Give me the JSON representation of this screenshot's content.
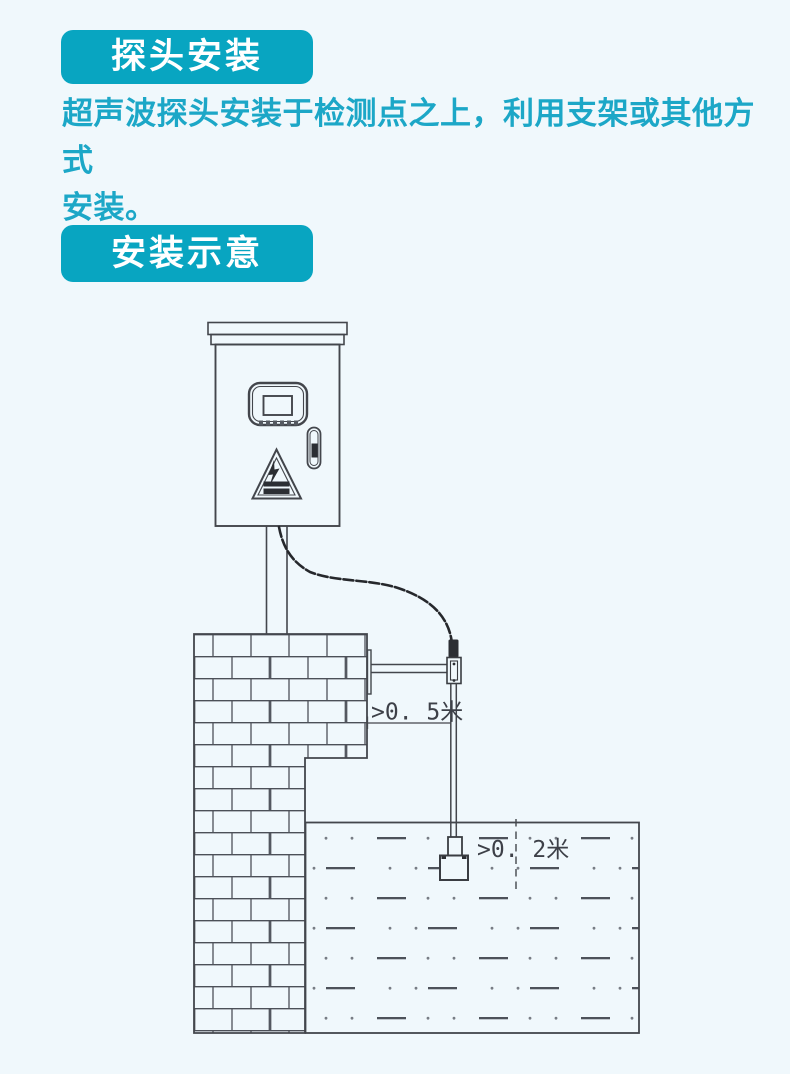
{
  "page": {
    "background_color": "#f0f8fc",
    "accent_color": "#08a5c1",
    "text_color": "#1ca7c7",
    "line_color": "#43464c"
  },
  "sections": {
    "probe_install": {
      "badge": "探头安装",
      "body": "超声波探头安装于检测点之上，利用支架或其他方式安装。",
      "body_lines": [
        "超声波探头安装于检测点之上，利用支架或其他方式",
        "安装。"
      ]
    },
    "install_diagram": {
      "badge": "安装示意"
    }
  },
  "diagram": {
    "dimension_labels": {
      "bracket_to_wall": ">0. 5米",
      "sensor_to_water": ">0. 2米"
    }
  }
}
